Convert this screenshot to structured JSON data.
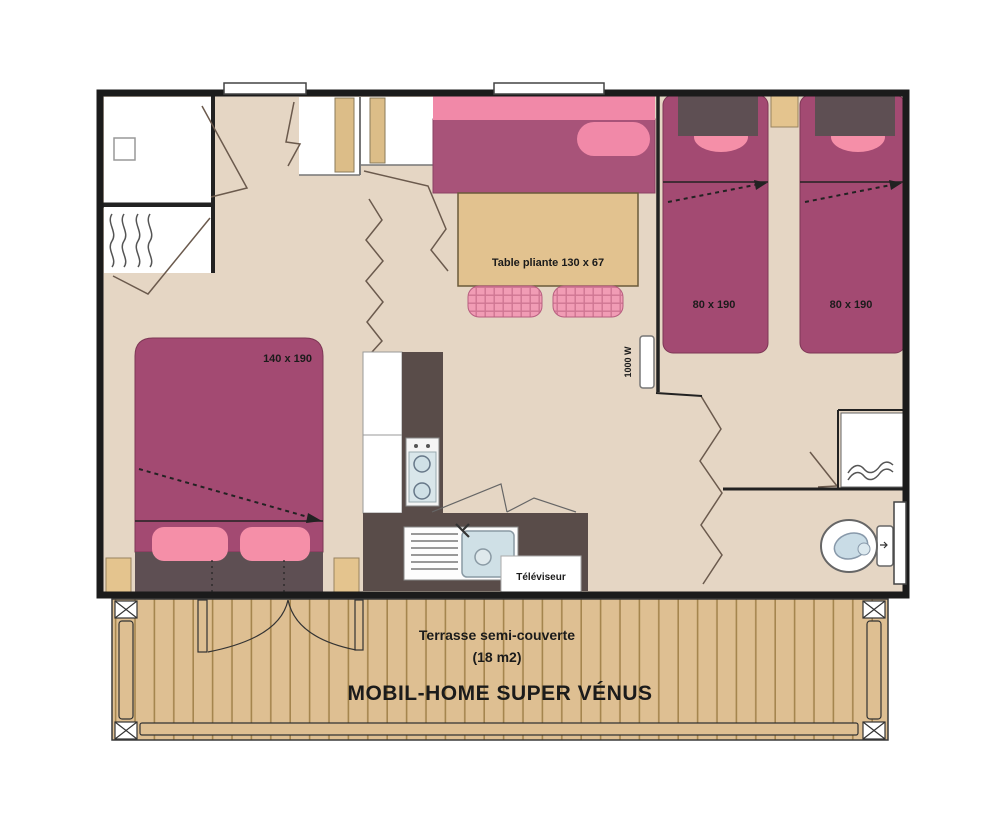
{
  "plan": {
    "type": "mobile-home floor plan",
    "labels": {
      "master_bed": "140 x 190",
      "single_bed_left": "80 x 190",
      "single_bed_right": "80 x 190",
      "table": "Table pliante 130 x 67",
      "tv": "Téléviseur",
      "heater": "1000 W"
    },
    "terrace": {
      "subtitle1": "Terrasse semi-couverte",
      "subtitle2": "(18 m2)",
      "title": "MOBIL-HOME SUPER VÉNUS"
    },
    "colors": {
      "floor": "#e5d6c4",
      "wall": "#1b1b1b",
      "bed_magenta": "#a34a72",
      "sofa_magenta": "#a85379",
      "accent_pink": "#f48cab",
      "dark_brown": "#5e4f53",
      "counter_brown": "#594c49",
      "wood_tan": "#debf92",
      "table_tan": "#e2c28f",
      "fixture_blue": "#cfe0e6"
    }
  }
}
